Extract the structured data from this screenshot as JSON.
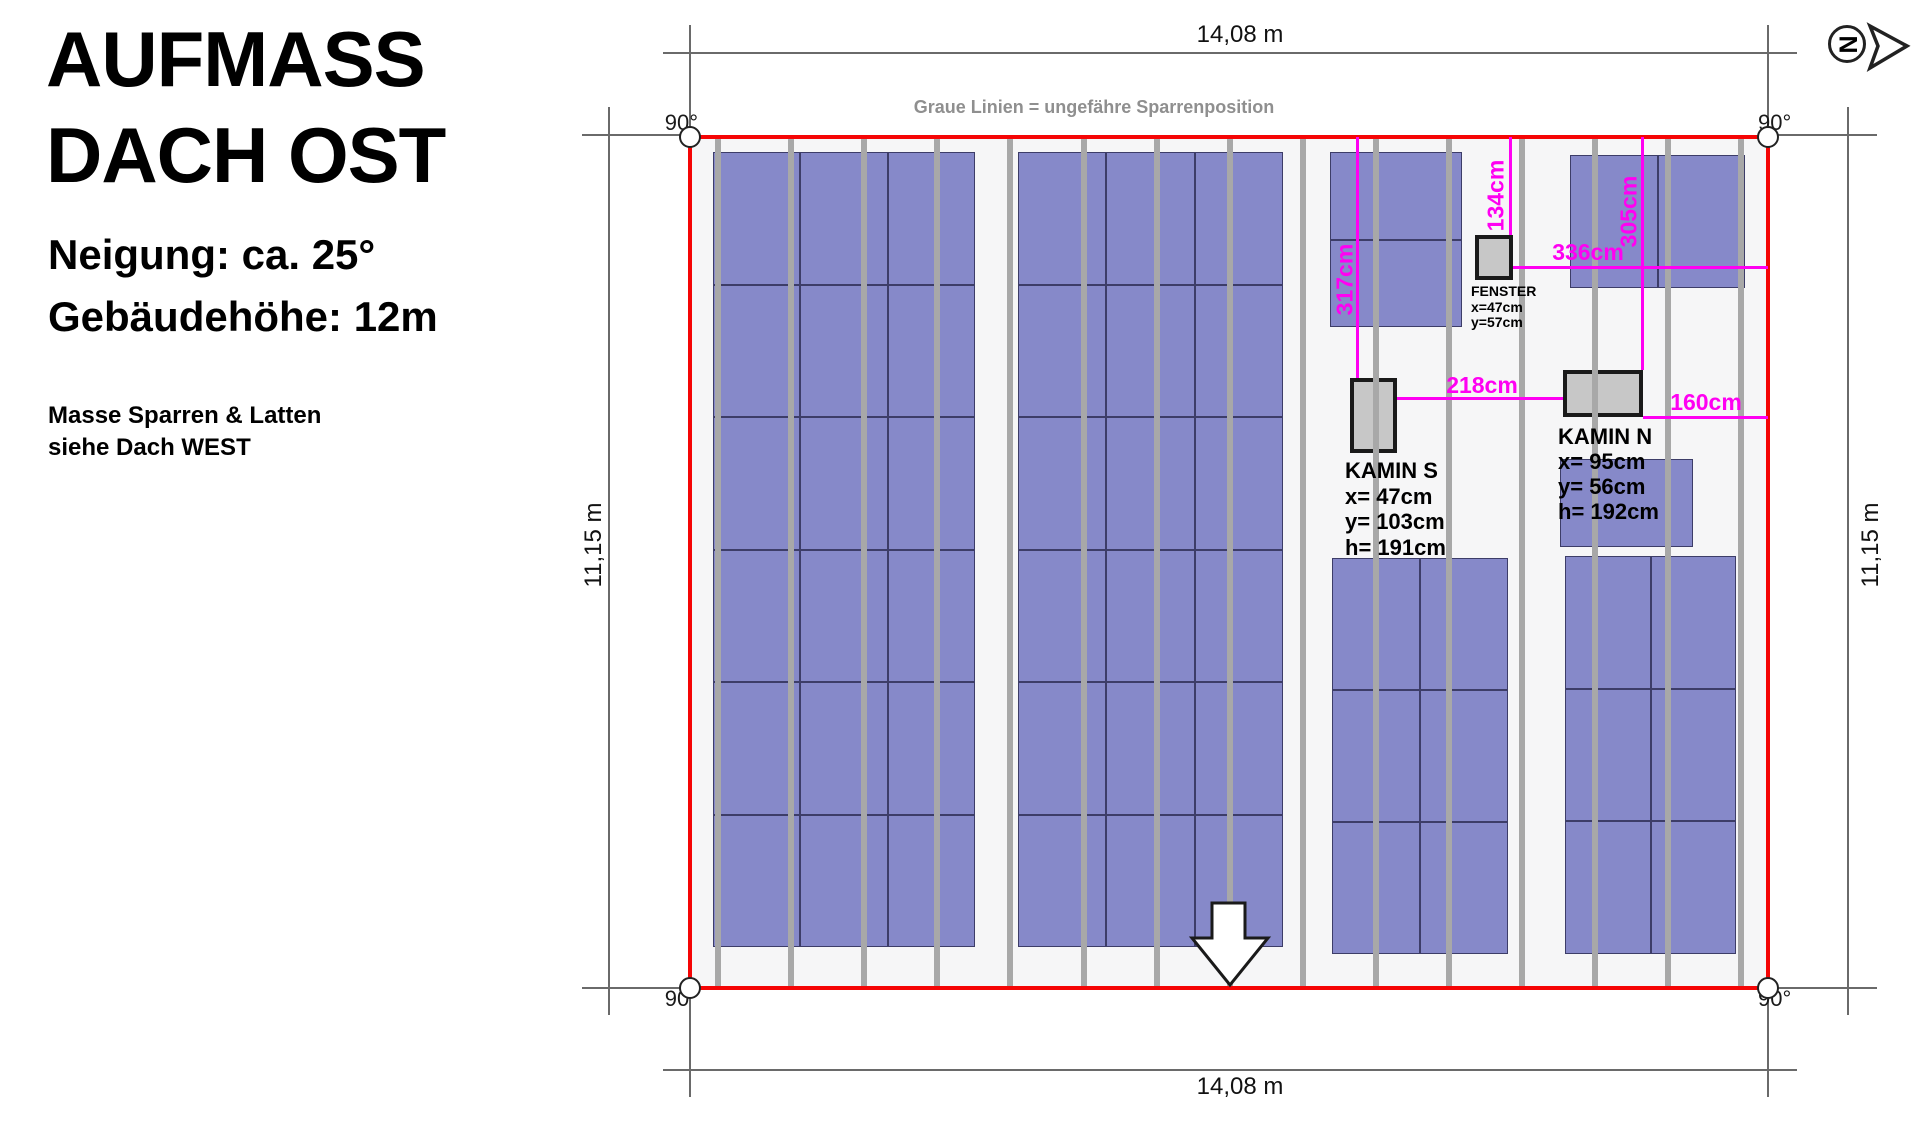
{
  "header": {
    "title_line1": "AUFMASS",
    "title_line2": "DACH OST",
    "subtitle_line1": "Neigung: ca. 25°",
    "subtitle_line2": "Gebäudehöhe: 12m",
    "note_line1": "Masse Sparren & Latten",
    "note_line2": "siehe Dach WEST"
  },
  "logo": {
    "letter": "N"
  },
  "diagram": {
    "legend_note": "Graue Linien = ungefähre Sparrenposition",
    "dims": {
      "top": "14,08 m",
      "bottom": "14,08 m",
      "left": "11,15 m",
      "right": "11,15 m"
    },
    "angles": [
      "90°",
      "90°",
      "90°",
      "90°"
    ],
    "colors": {
      "red": "#f50505",
      "magenta": "#ff00f2",
      "rafter": "#a8a8a8",
      "panel": "#8689c9",
      "panel_border": "#3d3d68",
      "dim_line": "#6a6a6a",
      "box_fill": "#c7c7c7",
      "box_border": "#1a1a1a",
      "roof_bg": "#f6f6f7",
      "note_gray": "#8f8f8f"
    },
    "roof": {
      "x": 690,
      "y": 137,
      "w": 1078,
      "h": 851
    },
    "rafters": {
      "y1": 139,
      "y2": 986,
      "xs": [
        718,
        791,
        864,
        937,
        1010,
        1084,
        1157,
        1230,
        1303,
        1376,
        1449,
        1522,
        1595,
        1668,
        1741
      ]
    },
    "dim_lines": [
      {
        "x1": 663,
        "y1": 53,
        "x2": 1797,
        "y2": 53
      },
      {
        "x1": 663,
        "y1": 1070,
        "x2": 1797,
        "y2": 1070
      },
      {
        "x1": 609,
        "y1": 107,
        "x2": 609,
        "y2": 1015
      },
      {
        "x1": 1848,
        "y1": 107,
        "x2": 1848,
        "y2": 1015
      },
      {
        "x1": 690,
        "y1": 25,
        "x2": 690,
        "y2": 137
      },
      {
        "x1": 1768,
        "y1": 25,
        "x2": 1768,
        "y2": 137
      },
      {
        "x1": 690,
        "y1": 988,
        "x2": 690,
        "y2": 1097
      },
      {
        "x1": 1768,
        "y1": 988,
        "x2": 1768,
        "y2": 1097
      },
      {
        "x1": 582,
        "y1": 135,
        "x2": 690,
        "y2": 135
      },
      {
        "x1": 1768,
        "y1": 135,
        "x2": 1877,
        "y2": 135
      },
      {
        "x1": 582,
        "y1": 988,
        "x2": 690,
        "y2": 988
      },
      {
        "x1": 1768,
        "y1": 988,
        "x2": 1877,
        "y2": 988
      }
    ],
    "panel_groups": [
      {
        "x": 713,
        "y": 152,
        "cols": 3,
        "rows": 6,
        "cw": 87.3,
        "ch": 132.5
      },
      {
        "x": 1018,
        "y": 152,
        "cols": 3,
        "rows": 6,
        "cw": 88.3,
        "ch": 132.5
      },
      {
        "x": 1330,
        "y": 152,
        "cols": 1,
        "rows": 2,
        "cw": 132,
        "ch": 87.5
      },
      {
        "x": 1570,
        "y": 155,
        "cols": 2,
        "rows": 1,
        "cw": 87.5,
        "ch": 133
      },
      {
        "x": 1560,
        "y": 459,
        "cols": 1,
        "rows": 1,
        "cw": 133,
        "ch": 88
      },
      {
        "x": 1332,
        "y": 558,
        "cols": 2,
        "rows": 3,
        "cw": 88,
        "ch": 132
      },
      {
        "x": 1565,
        "y": 556,
        "cols": 2,
        "rows": 3,
        "cw": 85.5,
        "ch": 132.7
      }
    ],
    "boxes": [
      {
        "name": "fenster",
        "x": 1475,
        "y": 235,
        "w": 38,
        "h": 45,
        "label_lines": [
          "FENSTER",
          "x=47cm",
          "y=57cm"
        ],
        "label_x": 1471,
        "label_y": 283,
        "font": 14,
        "lh": 15.5
      },
      {
        "name": "kamin-s",
        "x": 1350,
        "y": 378,
        "w": 47,
        "h": 75,
        "label_lines": [
          "KAMIN S",
          "x= 47cm",
          "y= 103cm",
          "h= 191cm"
        ],
        "label_x": 1345,
        "label_y": 458,
        "font": 22,
        "lh": 25.5
      },
      {
        "name": "kamin-n",
        "x": 1563,
        "y": 370,
        "w": 80,
        "h": 47,
        "label_lines": [
          "KAMIN N",
          "x= 95cm",
          "y= 56cm",
          "h= 192cm"
        ],
        "label_x": 1558,
        "label_y": 424,
        "font": 22,
        "lh": 25
      }
    ],
    "measurements": [
      {
        "dir": "v",
        "x": 1357,
        "y1": 137,
        "y2": 378,
        "label": "317cm",
        "lx": 1345,
        "ly": 280,
        "rot": true
      },
      {
        "dir": "v",
        "x": 1510,
        "y1": 137,
        "y2": 235,
        "label": "134cm",
        "lx": 1496,
        "ly": 196,
        "rot": true
      },
      {
        "dir": "v",
        "x": 1642,
        "y1": 137,
        "y2": 370,
        "label": "305cm",
        "lx": 1629,
        "ly": 212,
        "rot": true
      },
      {
        "dir": "h",
        "y": 267,
        "x1": 1513,
        "x2": 1768,
        "label": "336cm",
        "lx": 1588,
        "ly": 253,
        "rot": false
      },
      {
        "dir": "h",
        "y": 398,
        "x1": 1397,
        "x2": 1563,
        "label": "218cm",
        "lx": 1482,
        "ly": 386,
        "rot": false
      },
      {
        "dir": "h",
        "y": 417,
        "x1": 1643,
        "x2": 1768,
        "label": "160cm",
        "lx": 1706,
        "ly": 403,
        "rot": false
      }
    ],
    "arrow": {
      "points": "1212,903 1245,903 1245,938 1268,938 1230,985 1192,938 1212,938"
    }
  }
}
